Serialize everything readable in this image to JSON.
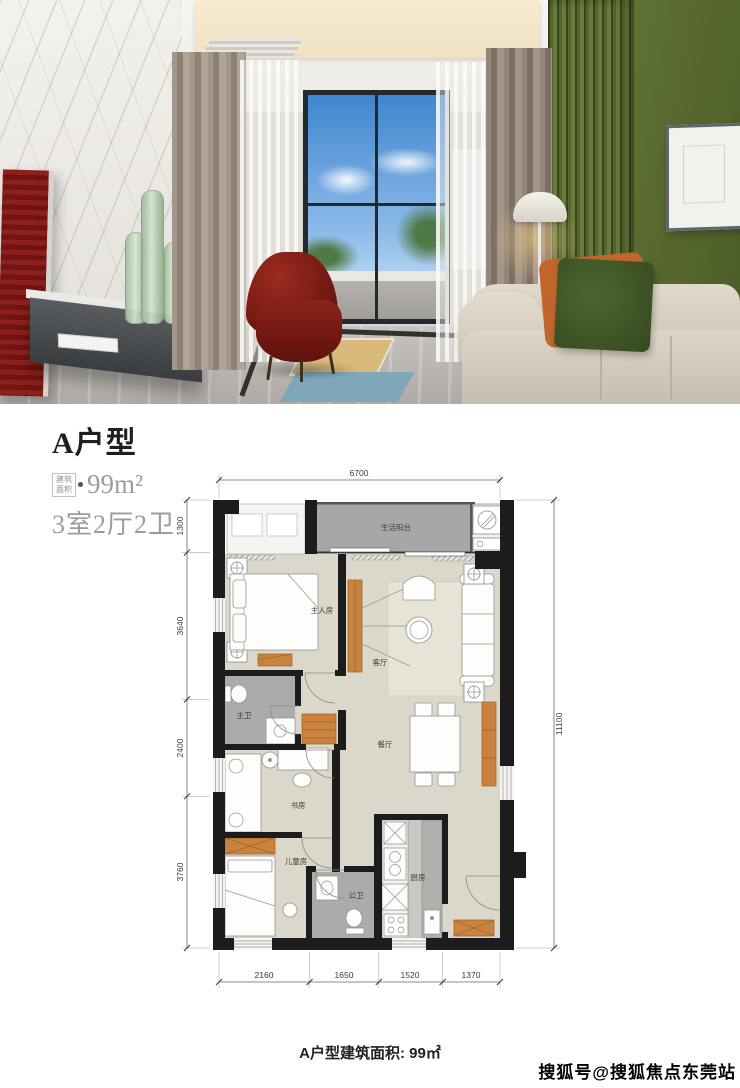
{
  "photo": {
    "accent_colors": {
      "wall_green": "#5f7134",
      "chair_red": "#7d1d17",
      "sofa_beige": "#d9d2c5",
      "pillow_orange": "#c2662c",
      "pillow_green": "#45602c",
      "marble_white": "#f0eeea"
    }
  },
  "title": {
    "name": "A户型",
    "area_badge_line1": "建筑",
    "area_badge_line2": "面积",
    "area": "99m²",
    "rooms": "3室2厅2卫"
  },
  "floorplan": {
    "rooms": {
      "balcony": "生活阳台",
      "master_bedroom": "主人房",
      "living": "客厅",
      "master_bath": "主卫",
      "dining": "餐厅",
      "study": "书房",
      "kids": "儿童房",
      "public_bath": "公卫",
      "kitchen": "厨房"
    },
    "dims": {
      "top": "6700",
      "right": "11100",
      "left": [
        "1300",
        "3640",
        "2400",
        "3760"
      ],
      "bottom": [
        "2160",
        "1650",
        "1520",
        "1370"
      ]
    }
  },
  "caption": "A户型建筑面积: 99㎡",
  "watermark": "搜狐号@搜狐焦点东莞站"
}
